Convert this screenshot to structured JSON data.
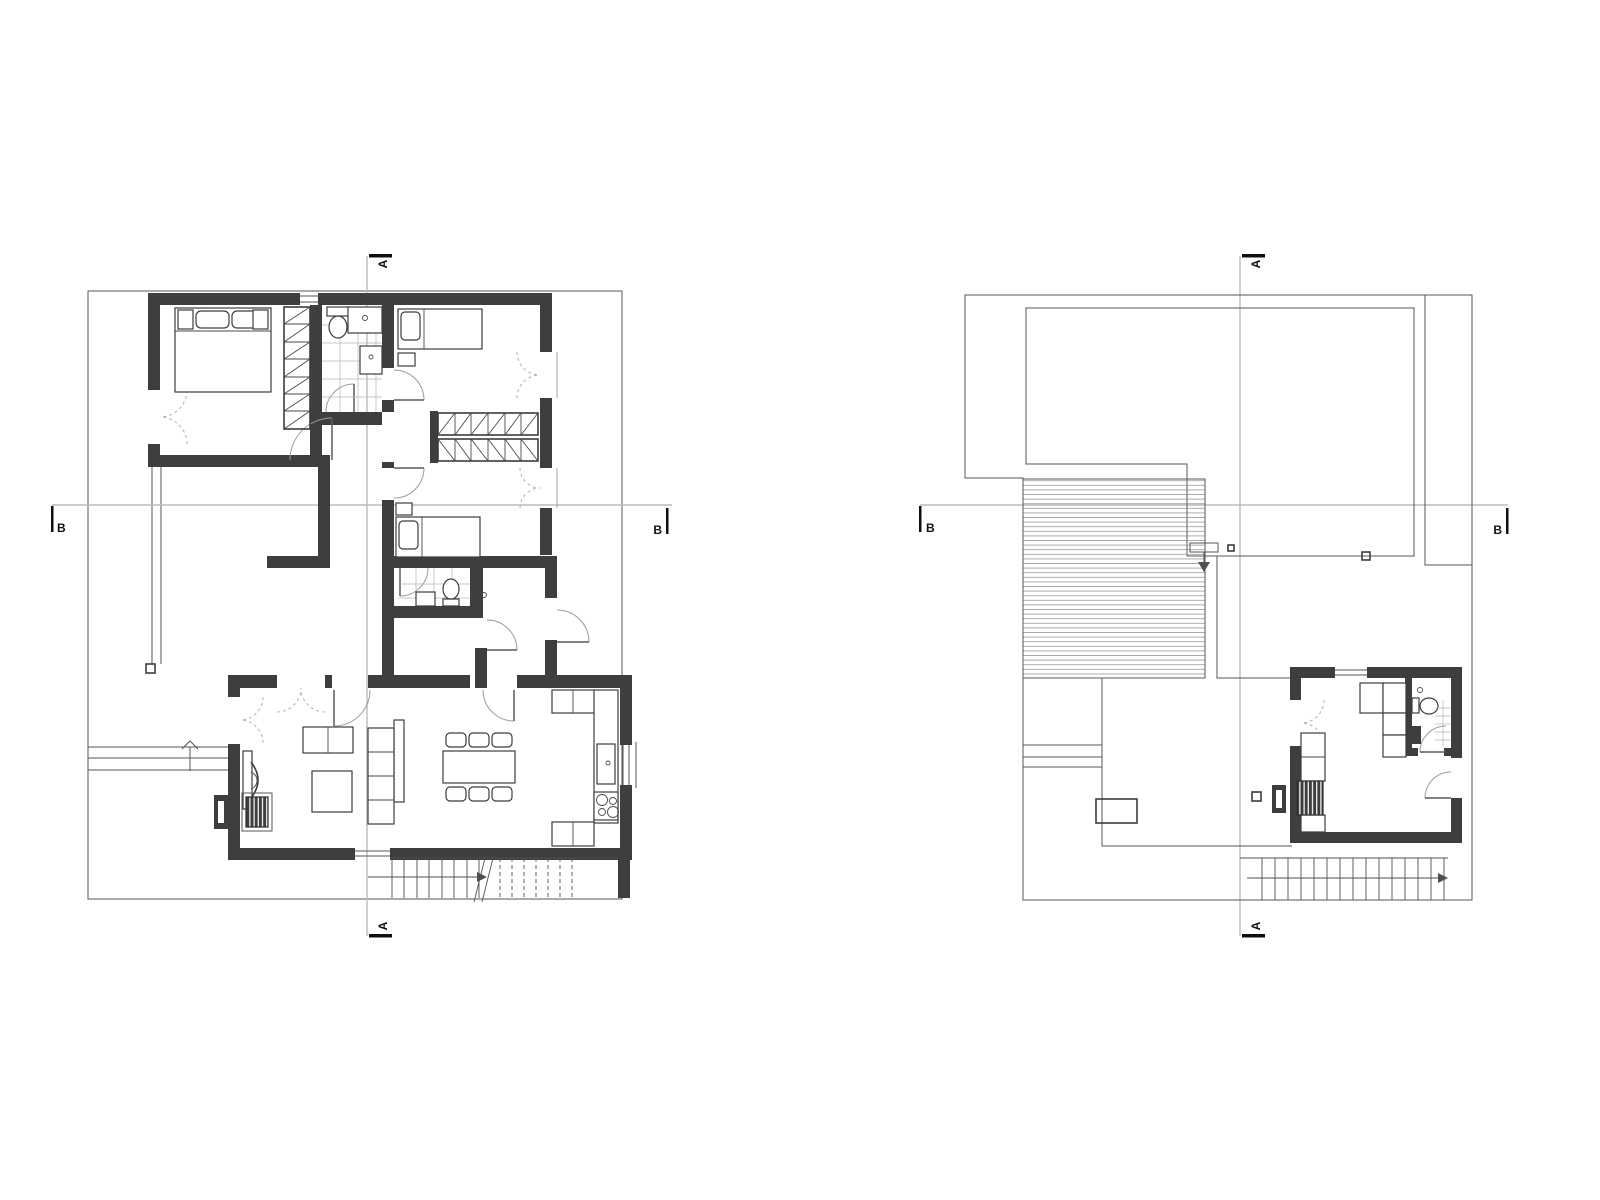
{
  "drawing": {
    "background": "#ffffff",
    "colors": {
      "wall": "#3e3e3e",
      "thin_line": "#565656",
      "section_line": "#bcbcbc",
      "marker": "#101010",
      "tile_grid": "#b5b5b5",
      "door_arc": "#9b9b9b"
    },
    "plans": [
      {
        "name": "ground-floor-plan",
        "markers": {
          "a_top": "A",
          "a_bottom": "A",
          "b_left": "B",
          "b_right": "B"
        }
      },
      {
        "name": "roof-plan",
        "markers": {
          "a_top": "A",
          "a_bottom": "A",
          "b_left": "B",
          "b_right": "B"
        }
      }
    ]
  }
}
